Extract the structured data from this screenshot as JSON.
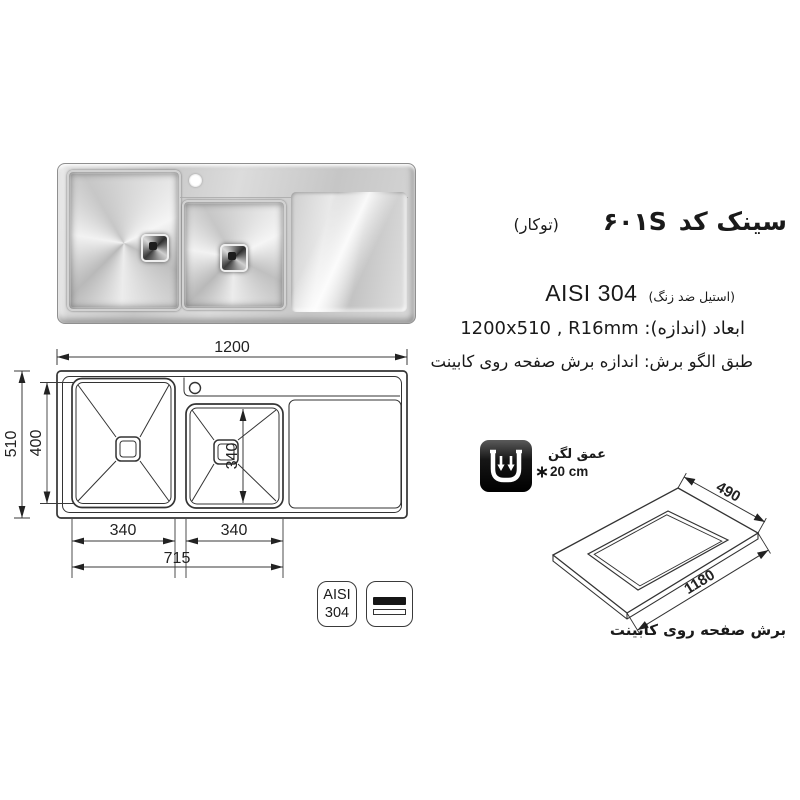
{
  "header": {
    "title": {
      "main": "سینک کد",
      "code": "۶۰۱S",
      "type_note": "(توکار)"
    },
    "material": {
      "grade": "AISI 304",
      "note": "(استیل ضد زنگ)"
    },
    "size_line": "ابعاد (اندازه): 1200x510 , R16mm",
    "cut_line": "طبق الگو برش: اندازه برش صفحه روی کابینت"
  },
  "plan_figure": {
    "dim_total_width": "1200",
    "dim_total_depth": "510",
    "dim_bowl_depth": "400",
    "dim_bowl1_width": "340",
    "dim_bowl2_width": "340",
    "dim_bowl2_height": "340",
    "dim_bowls_span": "715"
  },
  "cutout_figure": {
    "dim_depth": "490",
    "dim_width": "1180",
    "caption": "برش صفحه روی کابینت"
  },
  "depth_badge": {
    "label": "عمق لگن",
    "value": "20 cm"
  },
  "material_badges": {
    "aisi_top": "AISI",
    "aisi_bottom": "304"
  },
  "colors": {
    "line": "#333333",
    "text": "#1a1a1a",
    "icon_bg": "#000000"
  }
}
